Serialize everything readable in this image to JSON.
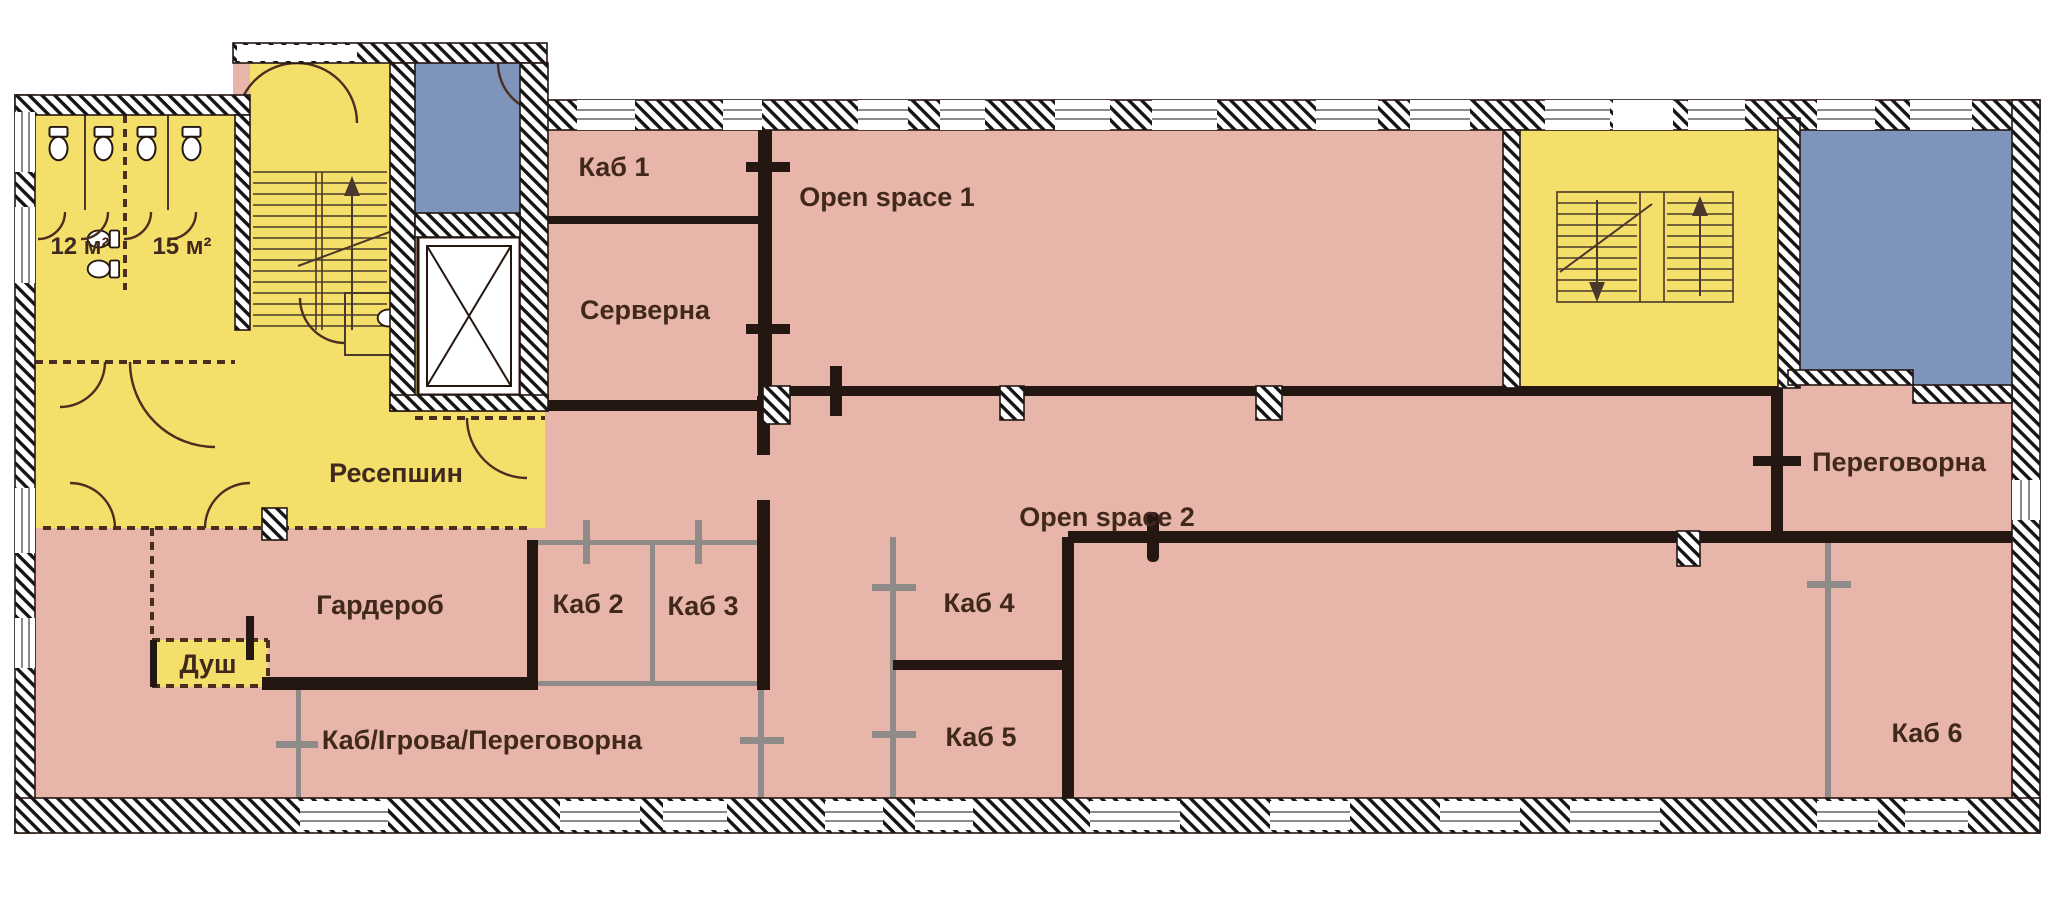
{
  "plan": {
    "type": "floor-plan",
    "language": "uk",
    "colors": {
      "room_pink": "#e8b5ab",
      "room_yellow": "#f4df6b",
      "room_blue": "#7e94ba",
      "wall_dark": "#241712",
      "wall_gray": "#8f8b88",
      "label_text": "#40291c",
      "background": "#ffffff"
    },
    "rooms": {
      "wc_12": {
        "label": "12 м²"
      },
      "wc_15": {
        "label": "15 м²"
      },
      "kab_1": {
        "label": "Каб 1"
      },
      "serverna": {
        "label": "Серверна"
      },
      "open_space_1": {
        "label": "Open space 1"
      },
      "resepshyn": {
        "label": "Ресепшин"
      },
      "harderob": {
        "label": "Гардероб"
      },
      "dush": {
        "label": "Душ"
      },
      "kab_2": {
        "label": "Каб 2"
      },
      "kab_3": {
        "label": "Каб 3"
      },
      "kab_ihrova_perehovorna": {
        "label": "Каб/Ігрова/Переговорна"
      },
      "kab_4": {
        "label": "Каб 4"
      },
      "kab_5": {
        "label": "Каб 5"
      },
      "open_space_2": {
        "label": "Open space 2"
      },
      "perehovorna": {
        "label": "Переговорна"
      },
      "kab_6": {
        "label": "Каб 6"
      }
    }
  }
}
